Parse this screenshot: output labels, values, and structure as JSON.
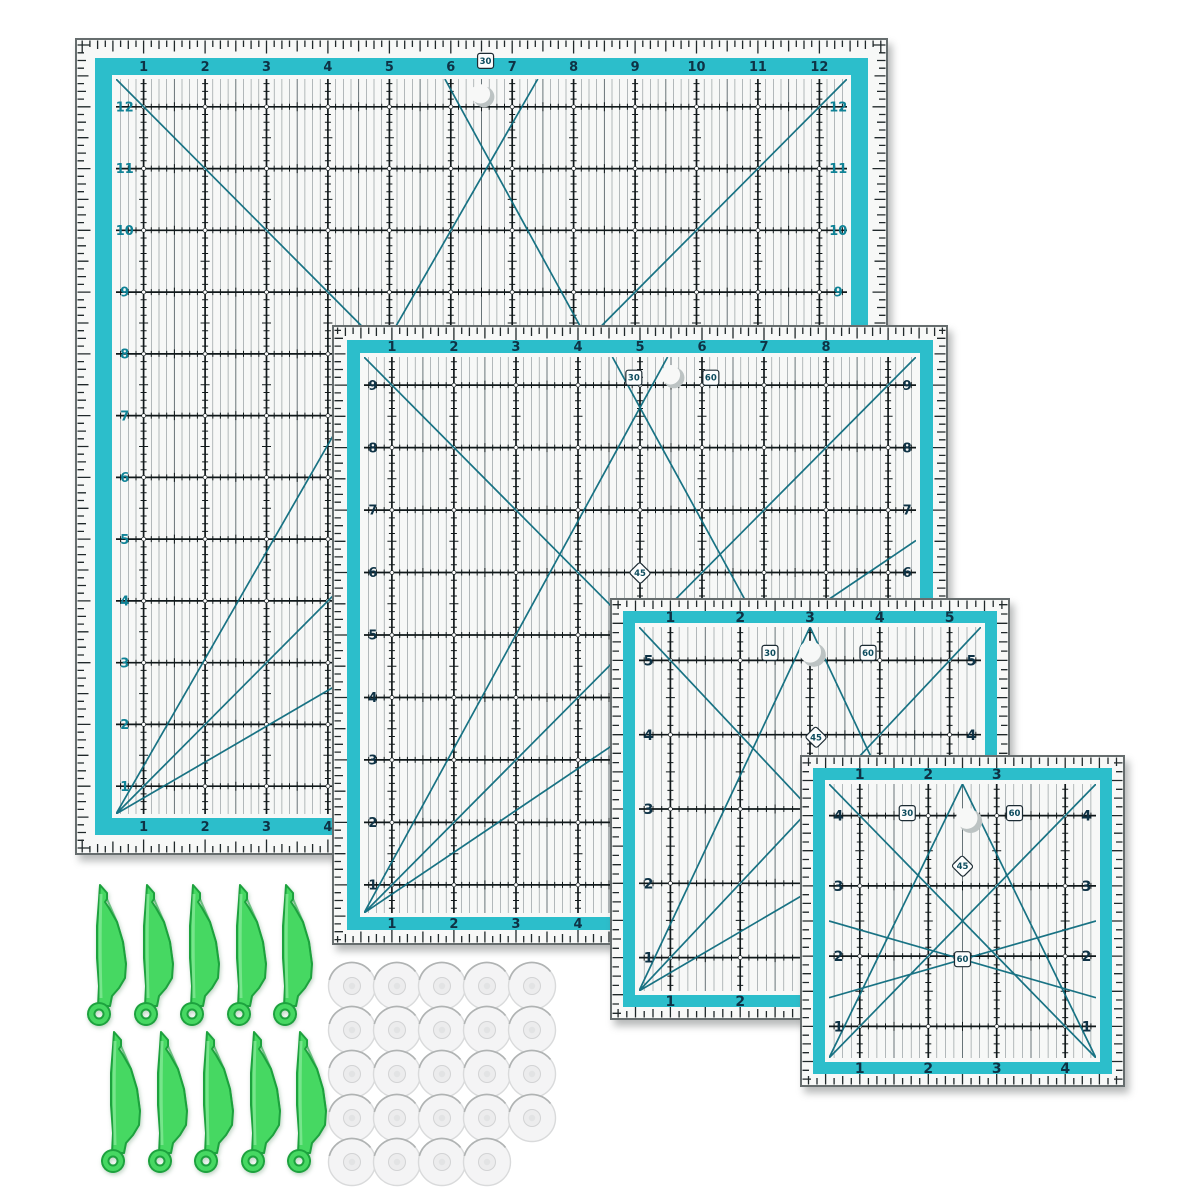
{
  "scene": {
    "name": "quilting-ruler-set-product-photo",
    "background": "#ffffff"
  },
  "colors": {
    "teal_band": "#2cbecb",
    "teal_diagonal": "#0d6b7d",
    "teal_side_number": "#0f8296",
    "number_navy": "#0e3245",
    "badge_text": "#0d4c5e",
    "grid_line": "#10181a",
    "grid_thin": "#47555a",
    "tick_black": "#20282a",
    "ruler_bg": "#f7f8f7",
    "ruler_edge": "#666d6e",
    "hole_gray": "#bcc3c3",
    "clip_green": "#46d862",
    "clip_green_dark": "#1da23e",
    "clip_highlight": "#9ff0ad",
    "disc_fill": "#f4f4f5",
    "disc_rim": "#d9dadb",
    "disc_shine": "#b0b3b3"
  },
  "rulers": [
    {
      "name": "quilting-ruler-12-inch",
      "x": 75,
      "y": 38,
      "w": 813,
      "h": 817,
      "cols": 12,
      "rows": 12,
      "top_numbers": [
        1,
        2,
        3,
        4,
        5,
        6,
        7,
        8,
        9,
        10,
        11,
        12
      ],
      "left_numbers": [
        12,
        11,
        10,
        9,
        8,
        7,
        6,
        5,
        4,
        3,
        2,
        1
      ],
      "right_numbers": [
        12,
        11,
        10,
        9,
        8,
        7,
        6,
        5,
        4,
        3,
        2,
        1
      ],
      "bottom_numbers": [
        1,
        2,
        3,
        4,
        5,
        6,
        7,
        8,
        9,
        10,
        11,
        12
      ],
      "side_number_color": "teal",
      "badges": [
        {
          "label": "30",
          "fx": 0.505,
          "fy": 0.028
        }
      ],
      "holes": [
        {
          "fx": 0.503,
          "fy": 0.072
        }
      ],
      "diagonals": [
        [
          0,
          0,
          1,
          1
        ],
        [
          0,
          1,
          1,
          0
        ],
        [
          0,
          1,
          0.577,
          0
        ],
        [
          0,
          1,
          1,
          0.42
        ],
        [
          1,
          1,
          0.45,
          0
        ]
      ]
    },
    {
      "name": "quilting-ruler-9-inch",
      "x": 332,
      "y": 325,
      "w": 616,
      "h": 620,
      "cols": 9,
      "rows": 9,
      "top_numbers": [
        1,
        2,
        3,
        4,
        5,
        6,
        7,
        8
      ],
      "left_numbers": [
        9,
        8,
        7,
        6,
        5,
        4,
        3,
        2,
        1
      ],
      "right_numbers": [
        9,
        8,
        7,
        6,
        5,
        4,
        3,
        2,
        1
      ],
      "bottom_numbers": [
        1,
        2,
        3,
        4,
        5,
        6,
        7,
        8
      ],
      "side_number_color": "navy",
      "badges": [
        {
          "label": "30",
          "fx": 0.49,
          "fy": 0.085
        },
        {
          "label": "60",
          "fx": 0.615,
          "fy": 0.085
        },
        {
          "label": "45",
          "fx": 0.5,
          "fy": 0.4,
          "diamond": true
        }
      ],
      "holes": [
        {
          "fx": 0.555,
          "fy": 0.085
        }
      ],
      "diagonals": [
        [
          0,
          0,
          1,
          1
        ],
        [
          0,
          1,
          1,
          0
        ],
        [
          0,
          1,
          0.55,
          0
        ],
        [
          1,
          1,
          0.45,
          0
        ],
        [
          0,
          1,
          1,
          0.33
        ]
      ]
    },
    {
      "name": "quilting-ruler-5-inch",
      "x": 610,
      "y": 598,
      "w": 400,
      "h": 422,
      "cols": 5,
      "rows": 5,
      "top_numbers": [
        1,
        2,
        3,
        4,
        5
      ],
      "left_numbers": [
        5,
        4,
        3,
        2,
        1
      ],
      "right_numbers": [
        5,
        4,
        3,
        2,
        1
      ],
      "bottom_numbers": [
        1,
        2,
        3,
        4,
        5
      ],
      "side_number_color": "navy",
      "badges": [
        {
          "label": "30",
          "fx": 0.4,
          "fy": 0.13
        },
        {
          "label": "60",
          "fx": 0.645,
          "fy": 0.13
        },
        {
          "label": "45",
          "fx": 0.515,
          "fy": 0.33,
          "diamond": true
        }
      ],
      "holes": [
        {
          "fx": 0.51,
          "fy": 0.135
        }
      ],
      "diagonals": [
        [
          0,
          0,
          1,
          1
        ],
        [
          0,
          1,
          1,
          0
        ],
        [
          0,
          1,
          0.5,
          0
        ],
        [
          1,
          1,
          0.5,
          0
        ],
        [
          0,
          1,
          1,
          0.45
        ]
      ]
    },
    {
      "name": "quilting-ruler-4-inch",
      "x": 800,
      "y": 755,
      "w": 325,
      "h": 332,
      "cols": 4,
      "rows": 4,
      "top_numbers": [
        1,
        2,
        3
      ],
      "left_numbers": [
        4,
        3,
        2,
        1
      ],
      "right_numbers": [
        4,
        3,
        2,
        1
      ],
      "bottom_numbers": [
        1,
        2,
        3,
        4
      ],
      "side_number_color": "navy",
      "badges": [
        {
          "label": "30",
          "fx": 0.33,
          "fy": 0.175
        },
        {
          "label": "60",
          "fx": 0.66,
          "fy": 0.175
        },
        {
          "label": "45",
          "fx": 0.5,
          "fy": 0.335,
          "diamond": true
        },
        {
          "label": "60",
          "fx": 0.5,
          "fy": 0.615
        }
      ],
      "holes": [
        {
          "fx": 0.525,
          "fy": 0.2
        }
      ],
      "diagonals": [
        [
          0,
          0,
          1,
          1
        ],
        [
          0,
          1,
          1,
          0
        ],
        [
          0,
          1,
          0.5,
          0
        ],
        [
          1,
          1,
          0.5,
          0
        ],
        [
          0,
          0.78,
          1,
          0.5
        ],
        [
          0,
          0.5,
          1,
          0.78
        ]
      ]
    }
  ],
  "clips": {
    "name": "green-sewing-clips",
    "count": 10,
    "clip_w": 44,
    "clip_h": 148,
    "rows": [
      {
        "x": 85,
        "y": 882,
        "spacing": 46.5,
        "count": 5
      },
      {
        "x": 99,
        "y": 1029,
        "spacing": 46.5,
        "count": 5
      }
    ]
  },
  "discs": {
    "name": "clear-bobbin-discs",
    "count": 24,
    "diameter": 50,
    "x": 352,
    "y": 986,
    "dx": 45,
    "dy": 44,
    "row_counts": [
      5,
      5,
      5,
      5,
      4
    ]
  }
}
